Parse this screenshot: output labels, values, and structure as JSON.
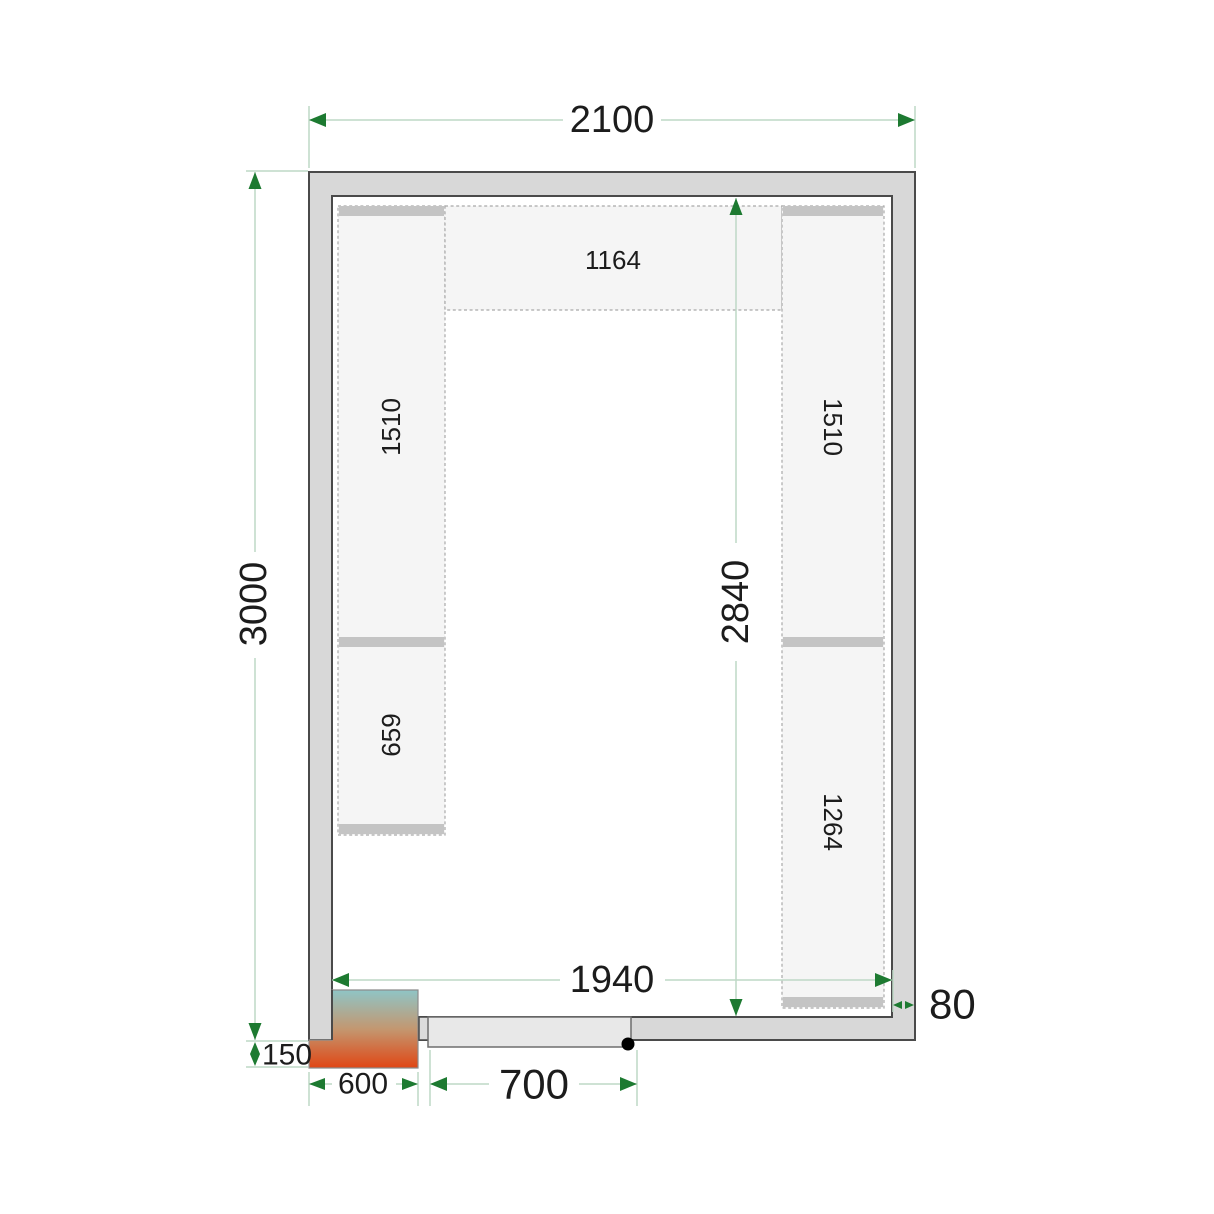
{
  "drawing": {
    "type": "cold-room-floor-plan",
    "dims": {
      "outer_width": "2100",
      "outer_height": "3000",
      "inner_width": "1940",
      "inner_height": "2840",
      "wall_thickness": "80",
      "door_width": "700",
      "unit_width": "600",
      "unit_offset": "150"
    },
    "shelves": {
      "top": "1164",
      "left_upper": "1510",
      "left_lower": "659",
      "right_upper": "1510",
      "right_lower": "1264"
    }
  },
  "colors": {
    "wall_fill": "#d8d8d8",
    "wall_outline": "#4a4a4a",
    "room_fill": "#ffffff",
    "shelf_fill": "#f5f5f5",
    "shelf_dash": "#a9a9a9",
    "shelf_bar": "#c4c4c4",
    "dim_line": "#bed8c6",
    "dim_arrow": "#1d7a31",
    "dim_text": "#1c1c1c",
    "unit_top": "#8fc5c6",
    "unit_mid": "#c39770",
    "unit_bottom": "#e04614",
    "door_fill": "#e8e8e8",
    "door_outline": "#6e6e6e",
    "stub_fill": "#dcdcdc",
    "dot": "#000000"
  }
}
